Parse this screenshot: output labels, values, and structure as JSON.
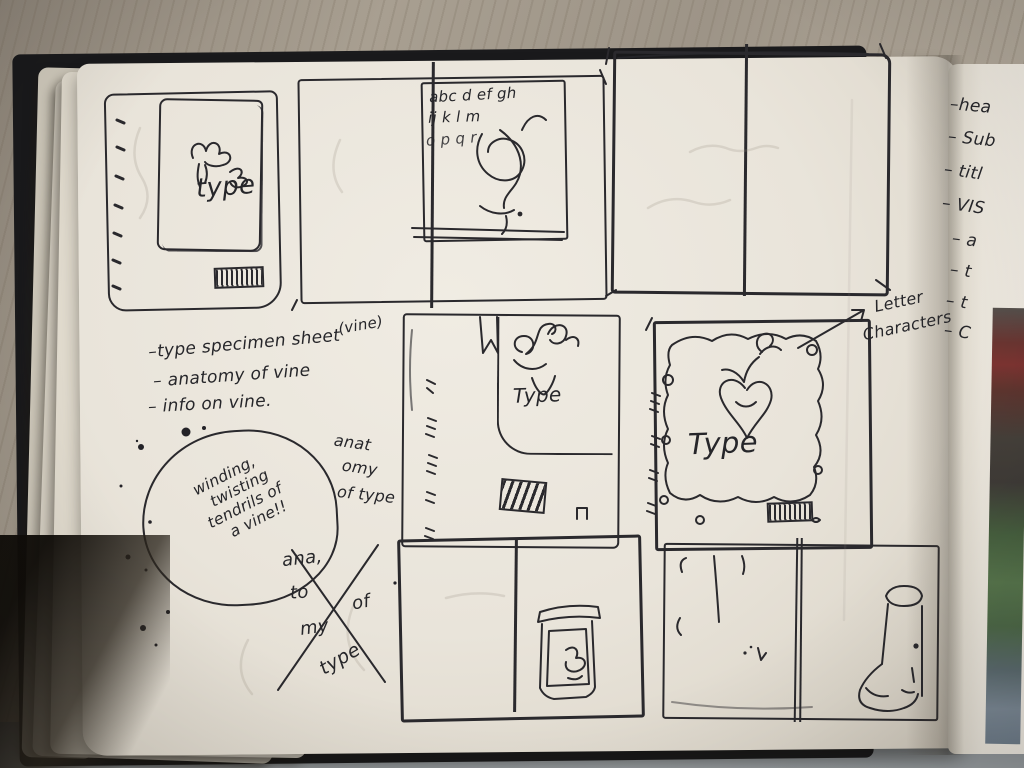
{
  "photo": {
    "description": "Photograph of an open sketchbook on a wooden desk showing hand-drawn thumbnail layout sketches for a vine-themed 'Type' specimen booklet"
  },
  "notes": {
    "dash": "–",
    "vine_label": "(vine)",
    "items": [
      "type specimen sheet",
      "anatomy of vine",
      "info on vine."
    ],
    "bubble": {
      "l1": "winding,",
      "l2": "twisting",
      "l3": "tendrils of",
      "l4": "a vine!!"
    },
    "anatomy": {
      "l1": "anat",
      "l2": "omy",
      "l3": "of type"
    },
    "crossed": {
      "w1": "ana,",
      "w2": "to",
      "w3": "my",
      "w4": "of",
      "w5": "type"
    },
    "letter_characters": {
      "l1": "Letter",
      "l2": "Characters"
    }
  },
  "sketches": {
    "cover_small": {
      "title": "type"
    },
    "spread_alphabet": {
      "l1": "abc d ef gh",
      "l2": "ij k l m",
      "l3": "o p q r"
    },
    "cover_vine": {
      "title": "Type"
    },
    "cover_border": {
      "title": "Type"
    }
  },
  "right_page": {
    "dash": "–",
    "items": [
      "hea",
      "Sub",
      "titl",
      "VIS",
      "a",
      "t",
      "t",
      "C"
    ]
  },
  "colors": {
    "ink": "#2a292d",
    "paper": "#e9e4da",
    "wood": "#a59c8e",
    "cover_black": "#1a1a1c",
    "desk_gray": "#8e9397",
    "photo_strip": [
      "#55504c",
      "#7d3431",
      "#45403a",
      "#57754c",
      "#7b8894"
    ]
  }
}
